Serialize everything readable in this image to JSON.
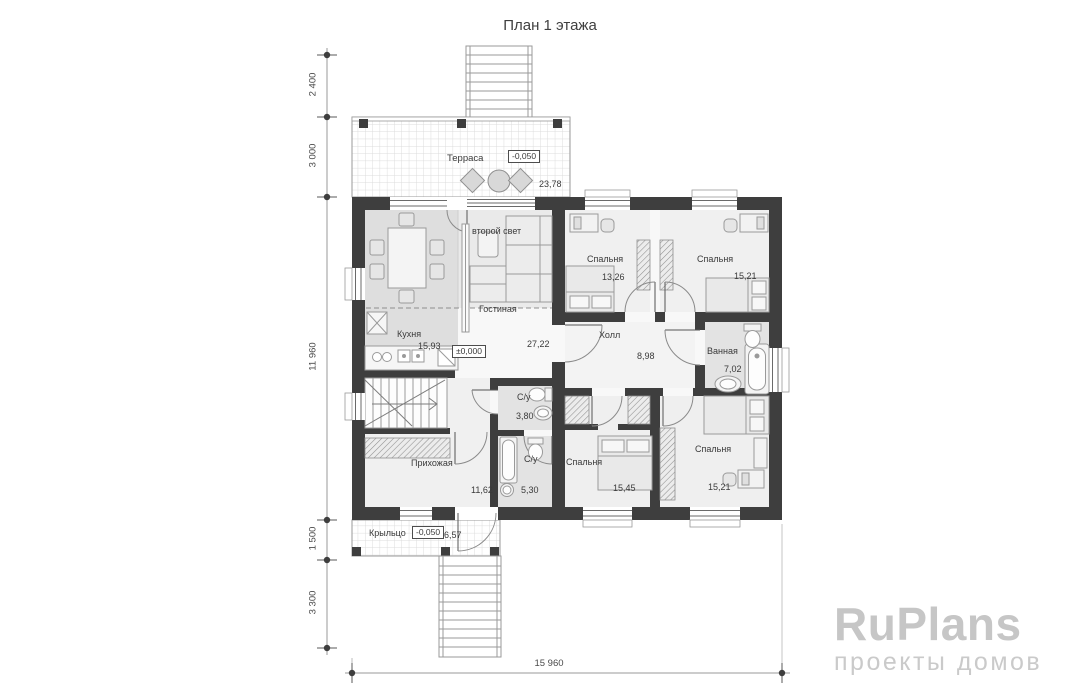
{
  "title": "План 1 этажа",
  "outdoor": {
    "terrace": {
      "label": "Терраса",
      "elevation": "-0,050",
      "area": "23,78"
    },
    "porch": {
      "label": "Крыльцо",
      "elevation": "-0,050",
      "area": "6,57"
    }
  },
  "rooms": {
    "kitchen": {
      "label": "Кухня",
      "area": "15,93"
    },
    "living": {
      "label": "Гостиная",
      "area": "27,22",
      "elevation": "±0,000",
      "second_light": "второй свет"
    },
    "bedroom_top_left": {
      "label": "Спальня",
      "area": "13,26"
    },
    "bedroom_top_right": {
      "label": "Спальня",
      "area": "15,21"
    },
    "hall": {
      "label": "Холл",
      "area": "8,98"
    },
    "bathroom": {
      "label": "Ванная",
      "area": "7,02"
    },
    "wc_small": {
      "label": "С/у",
      "area": "3,80"
    },
    "wc_large": {
      "label": "С/у",
      "area": "5,30"
    },
    "entry_hall": {
      "label": "Прихожая",
      "area": "11,62"
    },
    "bedroom_bottom_middle": {
      "label": "Спальня",
      "area": "15,45"
    },
    "bedroom_bottom_right": {
      "label": "Спальня",
      "area": "15,21"
    }
  },
  "dimensions": {
    "left": [
      "2 400",
      "3 000",
      "11 960",
      "1 500",
      "3 300"
    ],
    "bottom": "15 960"
  },
  "logo": {
    "name": "RuPlans",
    "tagline": "проекты домов"
  },
  "colors": {
    "wall": "#3e3e3e",
    "floor_accent": "#dedede",
    "wet_room": "#e3e3e3",
    "logo": "#c6c6c6"
  }
}
